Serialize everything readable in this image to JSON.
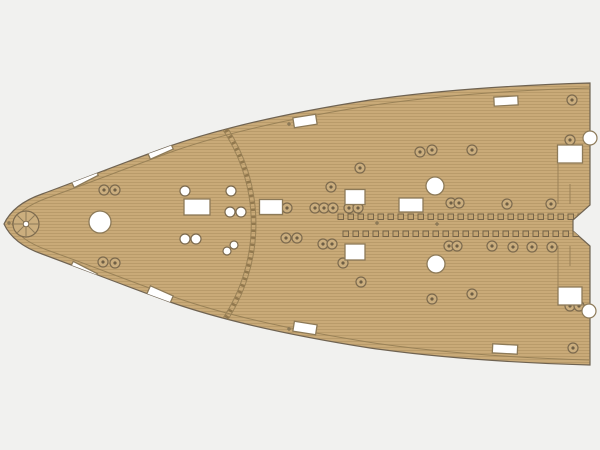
{
  "meta": {
    "description": "Photo of a tan wooden deck sheet (ship model kit part), bow section pointing left, with laser-cut white openings and fitting marks",
    "background_color": "#f1f1ef"
  },
  "deck_sheet": {
    "colors": {
      "base": "#c9aa78",
      "plank_line": "#a5885b",
      "outline": "#6f6352",
      "margin_line": "#9a8257",
      "cutout_fill": "#ffffff",
      "cutout_stroke": "#8d7a58",
      "ring_fill": "#cbae7e",
      "ring_stroke": "#7c6a4e",
      "ring_dot": "#6f5f45",
      "square_fill": "#c2a371",
      "square_stroke": "#6f5f45",
      "arc_line": "#9a8257",
      "arc_dash": "#8a7148",
      "mark_color": "#8d7a58"
    },
    "outline_path": "M 4,224 C 10,211 22,201 42,194 C 80,180 120,164 170,146 C 230,125 300,111 370,100 C 440,90 520,85 590,83 L 590,205 L 573,220 L 573,231 L 590,246 L 590,365 C 520,363 440,358 370,348 C 300,337 230,323 170,302 C 120,284 80,268 42,254 C 22,247 10,237 4,224 Z",
    "margin_top_path": "M 12,224 C 17,213 28,205 47,198 C 84,185 124,169 174,151 C 234,130 304,116 374,105 C 443,95 521,90 590,88",
    "margin_bottom_path": "M 12,224 C 17,235 28,243 47,250 C 84,263 124,279 174,297 C 234,318 304,332 374,343 C 443,353 521,358 590,360",
    "break_arc": {
      "outer_path": "M 225,124 A 177,177 0 0 1 225,324",
      "inner_path": "M 219,124 A 171,171 0 0 1 219,324",
      "dash_path": "M 222,124 A 174,174 0 0 1 222,324",
      "dash_pattern": "2.5 4.5"
    },
    "capstan_mark": {
      "cx": 26,
      "cy": 224,
      "r": 13,
      "spokes": 8,
      "hub_r": 2.8
    },
    "rect_cutouts": [
      {
        "cx": 84,
        "cy": 177,
        "w": 27,
        "h": 10,
        "angle": -27
      },
      {
        "cx": 160,
        "cy": 150,
        "w": 25,
        "h": 9,
        "angle": -24
      },
      {
        "cx": 305,
        "cy": 121,
        "w": 23,
        "h": 10,
        "angle": -9
      },
      {
        "cx": 506,
        "cy": 101,
        "w": 24,
        "h": 9,
        "angle": -3
      },
      {
        "cx": 197,
        "cy": 207,
        "w": 26,
        "h": 16,
        "angle": 0
      },
      {
        "cx": 271,
        "cy": 207,
        "w": 23,
        "h": 15,
        "angle": 0
      },
      {
        "cx": 355,
        "cy": 197,
        "w": 20,
        "h": 15,
        "angle": 0
      },
      {
        "cx": 411,
        "cy": 205,
        "w": 24,
        "h": 14,
        "angle": 0
      },
      {
        "cx": 570,
        "cy": 154,
        "w": 25,
        "h": 18,
        "angle": 0
      },
      {
        "cx": 83,
        "cy": 272,
        "w": 27,
        "h": 10,
        "angle": 27
      },
      {
        "cx": 160,
        "cy": 295,
        "w": 25,
        "h": 9,
        "angle": 24
      },
      {
        "cx": 305,
        "cy": 328,
        "w": 23,
        "h": 10,
        "angle": 9
      },
      {
        "cx": 505,
        "cy": 349,
        "w": 25,
        "h": 9,
        "angle": 3
      },
      {
        "cx": 355,
        "cy": 252,
        "w": 20,
        "h": 16,
        "angle": 0
      },
      {
        "cx": 570,
        "cy": 296,
        "w": 24,
        "h": 18,
        "angle": 0
      }
    ],
    "hole_cutouts": [
      {
        "cx": 100,
        "cy": 222,
        "r": 11
      },
      {
        "cx": 435,
        "cy": 186,
        "r": 9
      },
      {
        "cx": 436,
        "cy": 264,
        "r": 9
      }
    ],
    "edge_circles": [
      {
        "cx": 590,
        "cy": 138,
        "r": 7
      },
      {
        "cx": 589,
        "cy": 311,
        "r": 7
      }
    ],
    "small_hole_cutouts": [
      {
        "cx": 185,
        "cy": 191,
        "r": 5
      },
      {
        "cx": 231,
        "cy": 191,
        "r": 5
      },
      {
        "cx": 230,
        "cy": 212,
        "r": 5
      },
      {
        "cx": 241,
        "cy": 212,
        "r": 5
      },
      {
        "cx": 185,
        "cy": 239,
        "r": 5
      },
      {
        "cx": 196,
        "cy": 239,
        "r": 5
      },
      {
        "cx": 234,
        "cy": 245,
        "r": 4
      },
      {
        "cx": 227,
        "cy": 251,
        "r": 4
      }
    ],
    "ring_fittings": [
      {
        "cx": 103,
        "cy": 166
      },
      {
        "cx": 104,
        "cy": 190
      },
      {
        "cx": 115,
        "cy": 190
      },
      {
        "cx": 331,
        "cy": 187
      },
      {
        "cx": 360,
        "cy": 168
      },
      {
        "cx": 420,
        "cy": 152
      },
      {
        "cx": 432,
        "cy": 150
      },
      {
        "cx": 472,
        "cy": 150
      },
      {
        "cx": 572,
        "cy": 100
      },
      {
        "cx": 570,
        "cy": 140
      },
      {
        "cx": 287,
        "cy": 208
      },
      {
        "cx": 315,
        "cy": 208
      },
      {
        "cx": 324,
        "cy": 208
      },
      {
        "cx": 333,
        "cy": 208
      },
      {
        "cx": 349,
        "cy": 208
      },
      {
        "cx": 358,
        "cy": 208
      },
      {
        "cx": 451,
        "cy": 203
      },
      {
        "cx": 459,
        "cy": 203
      },
      {
        "cx": 507,
        "cy": 204
      },
      {
        "cx": 551,
        "cy": 204
      },
      {
        "cx": 286,
        "cy": 238
      },
      {
        "cx": 297,
        "cy": 238
      },
      {
        "cx": 323,
        "cy": 244
      },
      {
        "cx": 332,
        "cy": 244
      },
      {
        "cx": 343,
        "cy": 263
      },
      {
        "cx": 449,
        "cy": 246
      },
      {
        "cx": 457,
        "cy": 246
      },
      {
        "cx": 492,
        "cy": 246
      },
      {
        "cx": 513,
        "cy": 247
      },
      {
        "cx": 532,
        "cy": 247
      },
      {
        "cx": 552,
        "cy": 247
      },
      {
        "cx": 361,
        "cy": 282
      },
      {
        "cx": 432,
        "cy": 299
      },
      {
        "cx": 472,
        "cy": 294
      },
      {
        "cx": 103,
        "cy": 262
      },
      {
        "cx": 115,
        "cy": 263
      },
      {
        "cx": 570,
        "cy": 306
      },
      {
        "cx": 579,
        "cy": 306
      },
      {
        "cx": 573,
        "cy": 348
      }
    ],
    "square_mark_rows": [
      {
        "y": 214,
        "x_start": 338,
        "x_end": 588,
        "step": 10,
        "size": 5.5
      },
      {
        "y": 231,
        "x_start": 343,
        "x_end": 588,
        "step": 10,
        "size": 5.5
      }
    ],
    "center_marks": [
      {
        "x": 377,
        "y": 223
      },
      {
        "x": 437,
        "y": 224
      },
      {
        "x": 289,
        "y": 124
      },
      {
        "x": 289,
        "y": 329
      },
      {
        "x": 9,
        "y": 223
      }
    ],
    "plank_seams": [
      {
        "x": 558,
        "y1": 164,
        "y2": 204
      },
      {
        "x": 570,
        "y1": 184,
        "y2": 204
      },
      {
        "x": 558,
        "y1": 246,
        "y2": 286
      },
      {
        "x": 570,
        "y1": 246,
        "y2": 266
      }
    ]
  }
}
